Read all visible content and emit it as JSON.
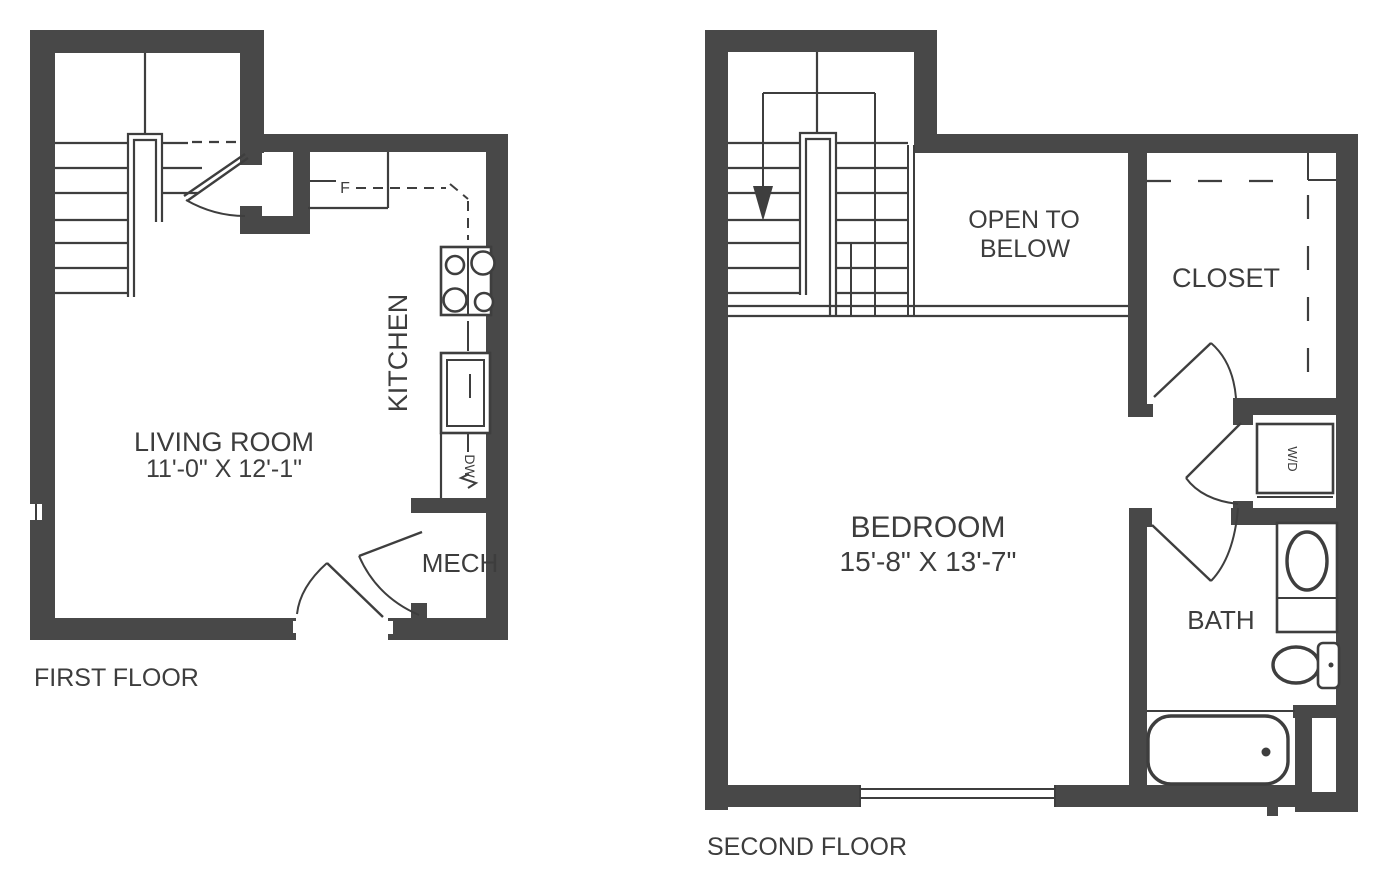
{
  "colors": {
    "wall": "#484848",
    "line": "#3e3e3e",
    "text": "#3d3d3d",
    "background": "#ffffff"
  },
  "first_floor": {
    "floor_label": "FIRST FLOOR",
    "living_room": {
      "name": "LIVING ROOM",
      "dimensions": "11'-0\" X 12'-1\""
    },
    "kitchen": {
      "name": "KITCHEN",
      "refrigerator_label": "F",
      "dishwasher_label": "DW"
    },
    "mech_room": {
      "name": "MECH"
    }
  },
  "second_floor": {
    "floor_label": "SECOND FLOOR",
    "bedroom": {
      "name": "BEDROOM",
      "dimensions": "15'-8\" X 13'-7\""
    },
    "open_to_below": {
      "line1": "OPEN TO",
      "line2": "BELOW"
    },
    "closet": {
      "name": "CLOSET"
    },
    "bath": {
      "name": "BATH",
      "washer_dryer_label": "W/D"
    }
  }
}
